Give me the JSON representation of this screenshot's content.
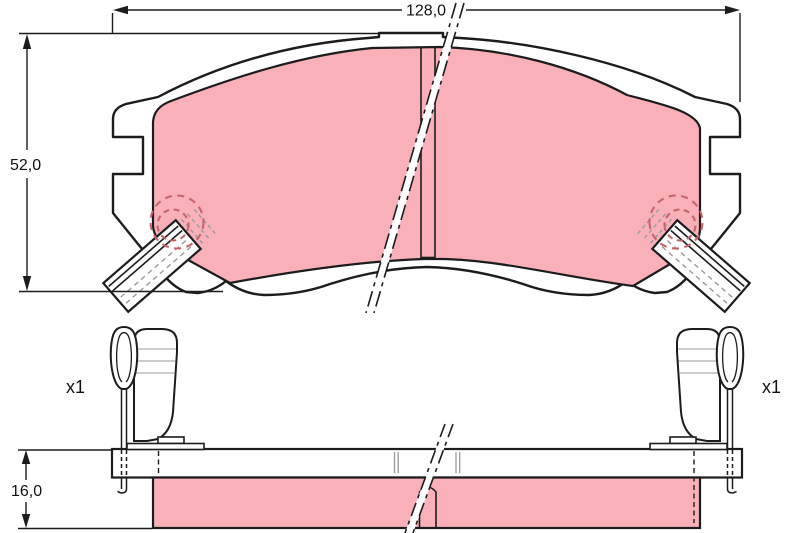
{
  "diagram": {
    "dimensions": {
      "width": "128,0",
      "height": "52,0",
      "thickness": "16,0"
    },
    "quantity": {
      "left": "x1",
      "right": "x1"
    },
    "colors": {
      "friction": "#f9b0b8",
      "outline": "#1c1c1c",
      "accessory_dash": "#c4646c",
      "gray": "#9a9a9a",
      "background": "#ffffff"
    }
  }
}
